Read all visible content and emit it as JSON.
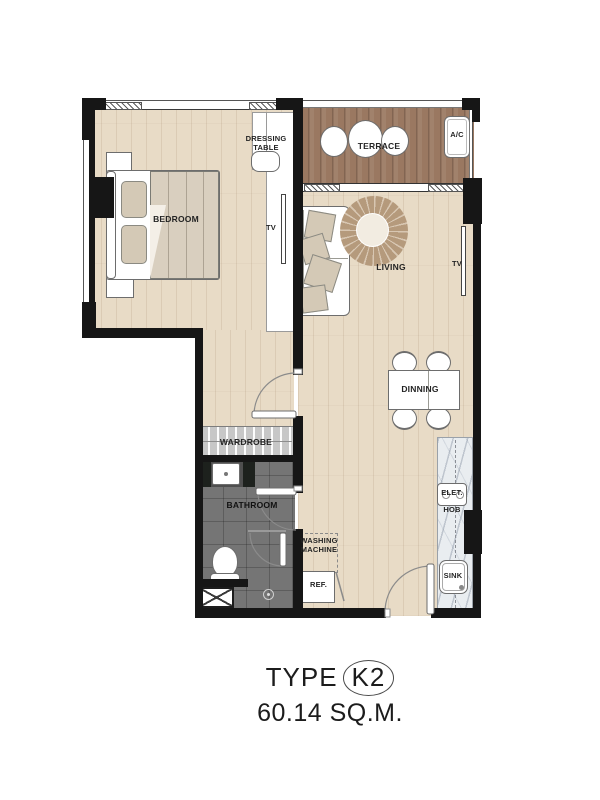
{
  "title": {
    "type_label": "TYPE",
    "type_code": "K2",
    "area": "60.14 SQ.M."
  },
  "labels": {
    "bedroom": "BEDROOM",
    "dressing_table": "DRESSING TABLE",
    "tv_bedroom": "TV",
    "terrace": "TERRACE",
    "ac": "A/C",
    "living": "LIVING",
    "tv_living": "TV",
    "dining": "DINNING",
    "wardrobe": "WARDROBE",
    "bathroom": "BATHROOM",
    "washing_machine": "WASHING MACHINE",
    "refrigerator": "REF.",
    "hob_line1": "ELET.",
    "hob_line2": "HOB",
    "sink": "SINK"
  },
  "colors": {
    "wall": "#161616",
    "wood_floor": "#e8dbc6",
    "terrace_deck": "#9a7861",
    "bathroom_tile": "#757575",
    "marble_counter": "#e9edf0",
    "cushion": "#d4c9b6",
    "rug": "#b59a7c"
  }
}
